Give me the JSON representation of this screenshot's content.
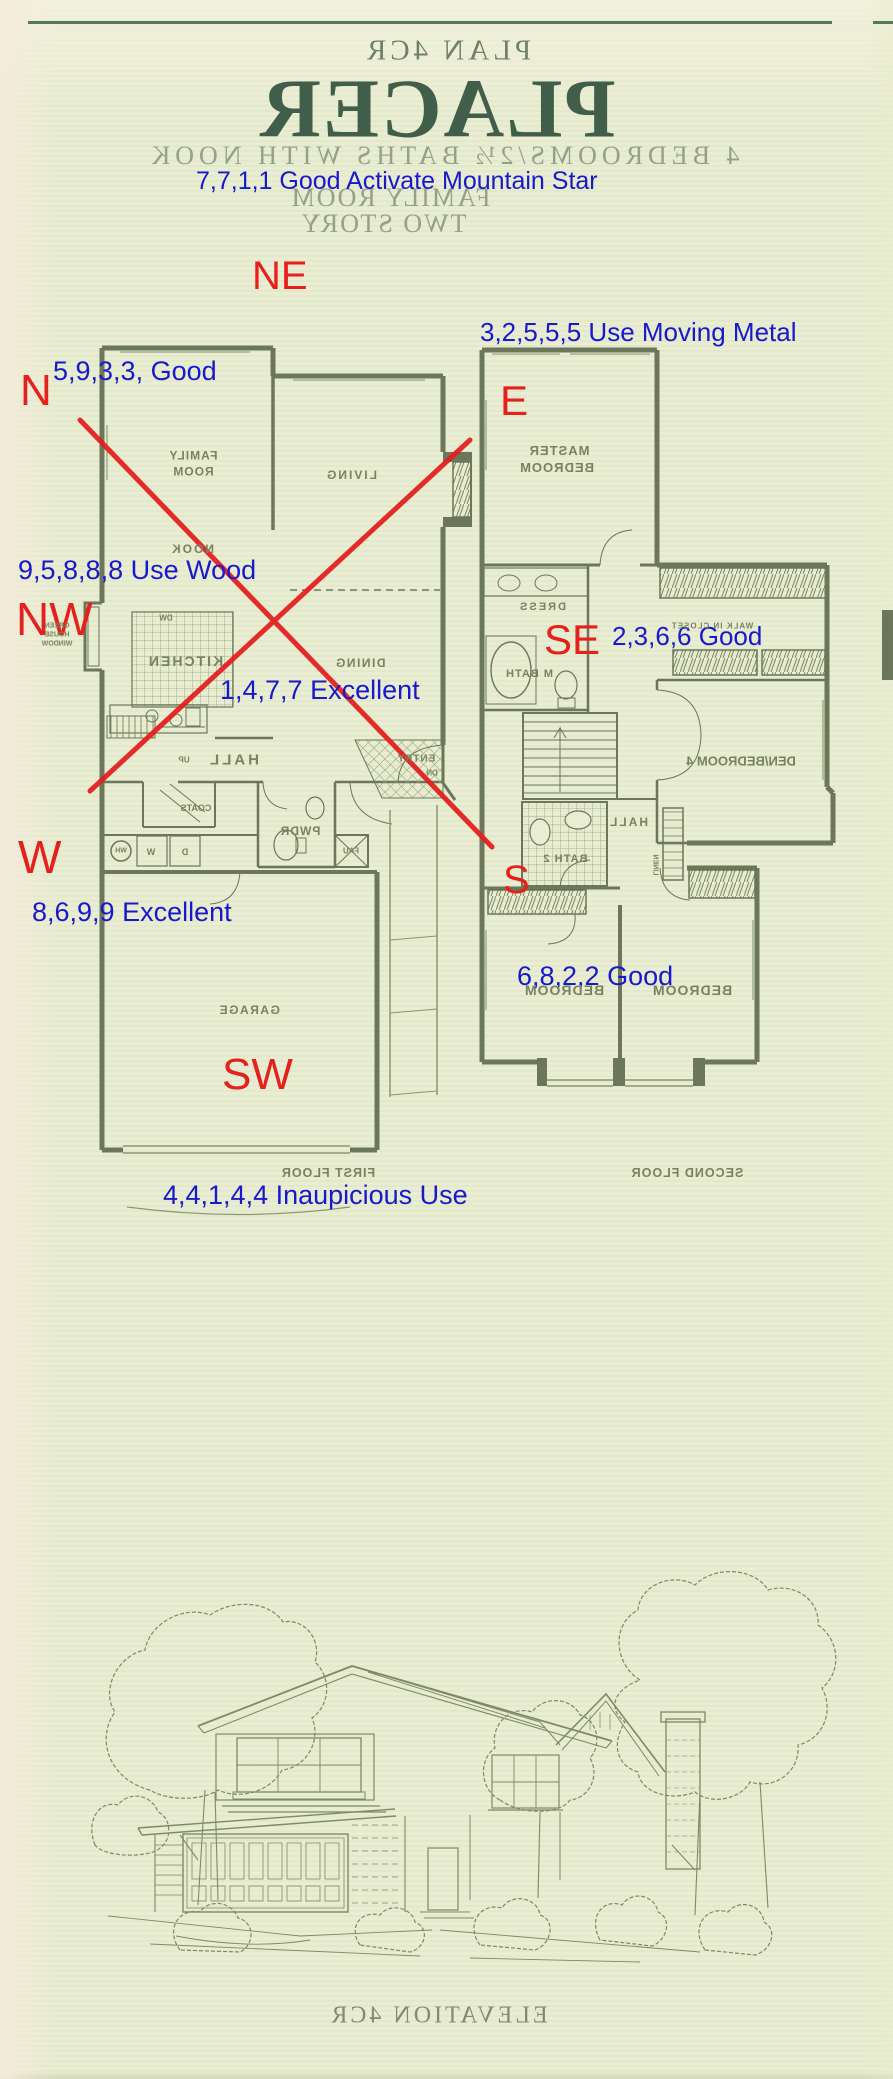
{
  "header": {
    "plan_code": "PLAN 4CR",
    "title": "PLACER",
    "subtitle": "4 BEDROOMS/2½ BATHS WITH NOOK",
    "feature_line": "FAMILY ROOM",
    "story_line": "TWO STORY"
  },
  "annotations": {
    "notes": [
      "7,7,1,1 Good Activate Mountain Star",
      "3,2,5,5,5  Use Moving Metal",
      "5,9,3,3, Good",
      "9,5,8,8,8 Use Wood",
      "1,4,7,7 Excellent",
      "2,3,6,6 Good",
      "8,6,9,9 Excellent",
      "6,8,2,2 Good",
      "4,4,1,4,4 Inaupicious Use"
    ],
    "directions": {
      "ne": "NE",
      "n": "N",
      "e": "E",
      "nw": "NW",
      "se": "SE",
      "w": "W",
      "s": "S",
      "sw": "SW"
    }
  },
  "first_floor": {
    "caption": "FIRST FLOOR",
    "rooms": {
      "family_room": "FAMILY ROOM",
      "living": "LIVING",
      "nook": "NOOK",
      "kitchen": "KITCHEN",
      "dining": "DINING",
      "hall": "HALL",
      "entry": "ENTRY",
      "powder": "PWDR",
      "coats": "COATS",
      "garage": "GARAGE"
    },
    "fixtures": {
      "greenhouse_window": "GREEN HOUSE WINDOW",
      "dishwasher": "DW",
      "stairs_up": "UP",
      "steps_down": "DN",
      "furnace": "FAU",
      "water_heater": "WH",
      "washer": "W",
      "dryer": "D"
    }
  },
  "second_floor": {
    "caption": "SECOND FLOOR",
    "rooms": {
      "master_bedroom": "MASTER BEDROOM",
      "dress": "DRESS",
      "master_bath": "M BATH",
      "walk_in_closet": "WALK IN CLOSET",
      "den_bedroom4": "DEN/BEDROOM 4",
      "hall": "HALL",
      "bath2": "BATH 2",
      "linen": "LINEN",
      "bedroom_left": "BEDROOM",
      "bedroom_right": "BEDROOM"
    }
  },
  "elevation": {
    "caption": "ELEVATION 4CR"
  },
  "colors": {
    "paper": "#e9edd2",
    "annotation_blue": "#1818cf",
    "annotation_red": "#e6201d",
    "plan_olive": "#6b765a",
    "header_dark_green": "#415e4a",
    "header_faint_green": "#94a18a",
    "rule_green": "#547a59"
  }
}
